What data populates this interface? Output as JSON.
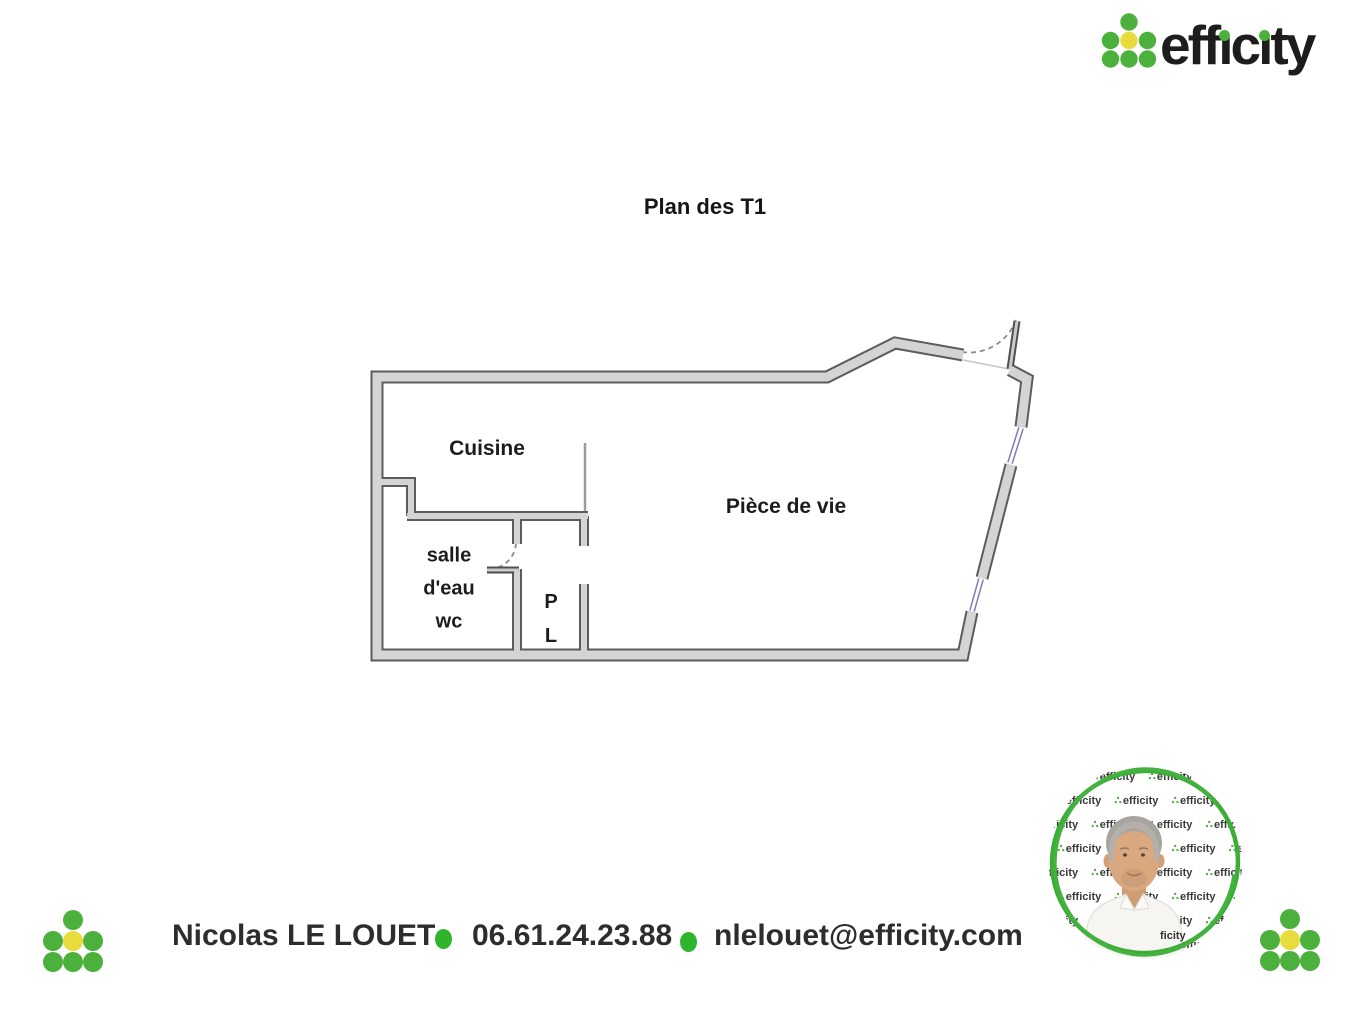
{
  "brand": {
    "logo_text_parts": {
      "p1": "eff",
      "i1": "ı",
      "p2": "c",
      "i2": "ı",
      "p3": "ty"
    },
    "green": "#4cb13c",
    "yellow": "#e8dc3d",
    "dark": "#1d1d1b",
    "bullet_green": "#2eb52c",
    "window_blue": "#7d7db8",
    "wall_fill": "#d4d4d4",
    "wall_edge": "#5c5c5c"
  },
  "title": "Plan des T1",
  "floor_plan": {
    "rooms": [
      {
        "label": "Cuisine"
      },
      {
        "label": "Pièce de vie"
      },
      {
        "label": "salle\nd'eau\nwc"
      },
      {
        "label": "P\nL"
      }
    ]
  },
  "footer": {
    "agent_name": "Nicolas LE LOUET",
    "phone": "06.61.24.23.88",
    "email": "nlelouet@efficity.com"
  },
  "avatar": {
    "watermark_text": "efficity",
    "watermark_fragment": "ficity"
  }
}
